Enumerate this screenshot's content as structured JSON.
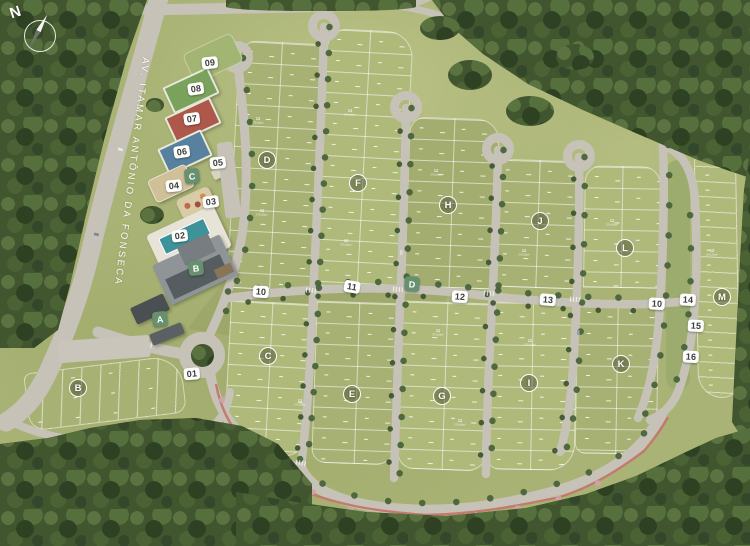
{
  "compass": {
    "label": "N"
  },
  "avenue": {
    "name": "AV. ITAMAR ANTÔNIO DA FONSECA"
  },
  "lots": {
    "sample_number": "12",
    "sample_area": "375,00m²",
    "sample_front": "15,00",
    "sample_side": "25,00"
  },
  "facility_badges": [
    {
      "label": "01",
      "x": 192,
      "y": 374,
      "rot": -5
    },
    {
      "label": "02",
      "x": 180,
      "y": 236,
      "rot": -7
    },
    {
      "label": "03",
      "x": 211,
      "y": 202,
      "rot": -7
    },
    {
      "label": "04",
      "x": 174,
      "y": 186,
      "rot": -6
    },
    {
      "label": "05",
      "x": 218,
      "y": 163,
      "rot": -6
    },
    {
      "label": "06",
      "x": 182,
      "y": 152,
      "rot": -8
    },
    {
      "label": "07",
      "x": 192,
      "y": 119,
      "rot": -8
    },
    {
      "label": "08",
      "x": 196,
      "y": 89,
      "rot": -8
    },
    {
      "label": "09",
      "x": 210,
      "y": 63,
      "rot": -6
    }
  ],
  "street_badges": [
    {
      "label": "10",
      "x": 261,
      "y": 292,
      "rot": 4
    },
    {
      "label": "11",
      "x": 352,
      "y": 287,
      "rot": 10
    },
    {
      "label": "12",
      "x": 460,
      "y": 297,
      "rot": 4
    },
    {
      "label": "13",
      "x": 548,
      "y": 300,
      "rot": 5
    },
    {
      "label": "10",
      "x": 657,
      "y": 304,
      "rot": 3
    },
    {
      "label": "14",
      "x": 688,
      "y": 300,
      "rot": 3
    },
    {
      "label": "15",
      "x": 696,
      "y": 326,
      "rot": 3
    },
    {
      "label": "16",
      "x": 691,
      "y": 357,
      "rot": 3
    }
  ],
  "area_badges": [
    {
      "label": "A",
      "x": 160,
      "y": 319,
      "rot": -6
    },
    {
      "label": "B",
      "x": 196,
      "y": 268,
      "rot": -6
    },
    {
      "label": "C",
      "x": 192,
      "y": 176,
      "rot": -6
    },
    {
      "label": "D",
      "x": 412,
      "y": 284,
      "rot": 3
    }
  ],
  "block_circles": [
    {
      "label": "B",
      "x": 78,
      "y": 388
    },
    {
      "label": "C",
      "x": 268,
      "y": 356
    },
    {
      "label": "D",
      "x": 267,
      "y": 160
    },
    {
      "label": "E",
      "x": 352,
      "y": 394
    },
    {
      "label": "F",
      "x": 358,
      "y": 183
    },
    {
      "label": "G",
      "x": 442,
      "y": 396
    },
    {
      "label": "H",
      "x": 448,
      "y": 205
    },
    {
      "label": "I",
      "x": 529,
      "y": 383
    },
    {
      "label": "J",
      "x": 540,
      "y": 221
    },
    {
      "label": "K",
      "x": 621,
      "y": 364
    },
    {
      "label": "L",
      "x": 625,
      "y": 248
    },
    {
      "label": "M",
      "x": 722,
      "y": 297
    }
  ],
  "lot_labels": [
    {
      "x": 258,
      "y": 120,
      "rot": 3
    },
    {
      "x": 262,
      "y": 212,
      "rot": 3
    },
    {
      "x": 350,
      "y": 112,
      "rot": 3
    },
    {
      "x": 346,
      "y": 242,
      "rot": 3
    },
    {
      "x": 436,
      "y": 172,
      "rot": 2
    },
    {
      "x": 438,
      "y": 332,
      "rot": 2
    },
    {
      "x": 524,
      "y": 252,
      "rot": 2
    },
    {
      "x": 530,
      "y": 342,
      "rot": 2
    },
    {
      "x": 612,
      "y": 222,
      "rot": 1
    },
    {
      "x": 712,
      "y": 252,
      "rot": -1
    },
    {
      "x": 300,
      "y": 402,
      "rot": 3
    },
    {
      "x": 460,
      "y": 422,
      "rot": 2
    }
  ],
  "colors": {
    "grass": "#a9b375",
    "forest": "#41552f",
    "road": "#c6c2b7",
    "red_path": "#c4766b",
    "tree_street": "#47613a",
    "blossom": "#cfa3ad",
    "badge_green": "#66906e",
    "badge_white": "#fdfdfb",
    "badge_text": "#3c3f3c",
    "court_green": "#7ba25d",
    "court_red": "#ad584b",
    "court_blue": "#58809f",
    "sand": "#cfc098",
    "pool": "#3e939b",
    "roof_light": "#8f9597",
    "roof_dark": "#565d60"
  }
}
